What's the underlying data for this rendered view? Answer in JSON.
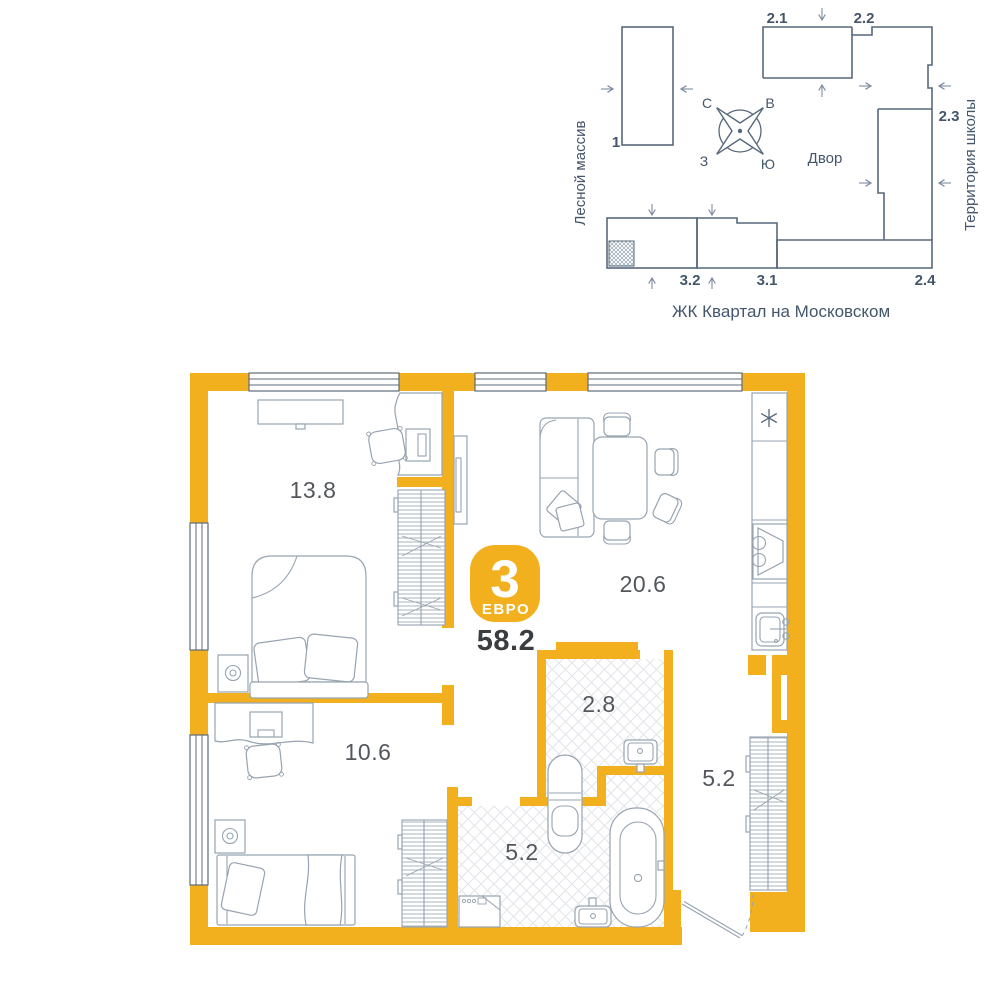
{
  "colors": {
    "accent": "#F2B01E",
    "siteline": "#56687B",
    "sitetext": "#44566B",
    "arrowcol": "#7E8CA0",
    "planline": "#5E6B78",
    "line": "#97A3B1",
    "hatch": "#E2E5E9",
    "arealabel": "#53575B",
    "textdark": "#3A3E41"
  },
  "site_plan": {
    "area_left_label": "Лесной массив",
    "area_right_label": "Территория школы",
    "courtyard_label": "Двор",
    "project_label": "ЖК Квартал на Московском",
    "buildings": {
      "b1": "1",
      "b21": "2.1",
      "b22": "2.2",
      "b23": "2.3",
      "b24": "2.4",
      "b31": "3.1",
      "b32": "3.2"
    },
    "compass": {
      "north": "С",
      "east": "В",
      "south": "Ю",
      "west": "З"
    }
  },
  "apartment": {
    "badge": {
      "rooms": "3",
      "type_label": "ЕВРО"
    },
    "total_area": "58.2",
    "rooms": [
      {
        "name": "bedroom-1",
        "area": "13.8"
      },
      {
        "name": "living-kitchen",
        "area": "20.6"
      },
      {
        "name": "bedroom-2",
        "area": "10.6"
      },
      {
        "name": "wc",
        "area": "2.8"
      },
      {
        "name": "bathroom",
        "area": "5.2"
      },
      {
        "name": "hallway",
        "area": "5.2"
      }
    ]
  },
  "icons": {
    "fridge_snowflake": "✳",
    "compass": "✦",
    "entrance_arrow": "→"
  }
}
